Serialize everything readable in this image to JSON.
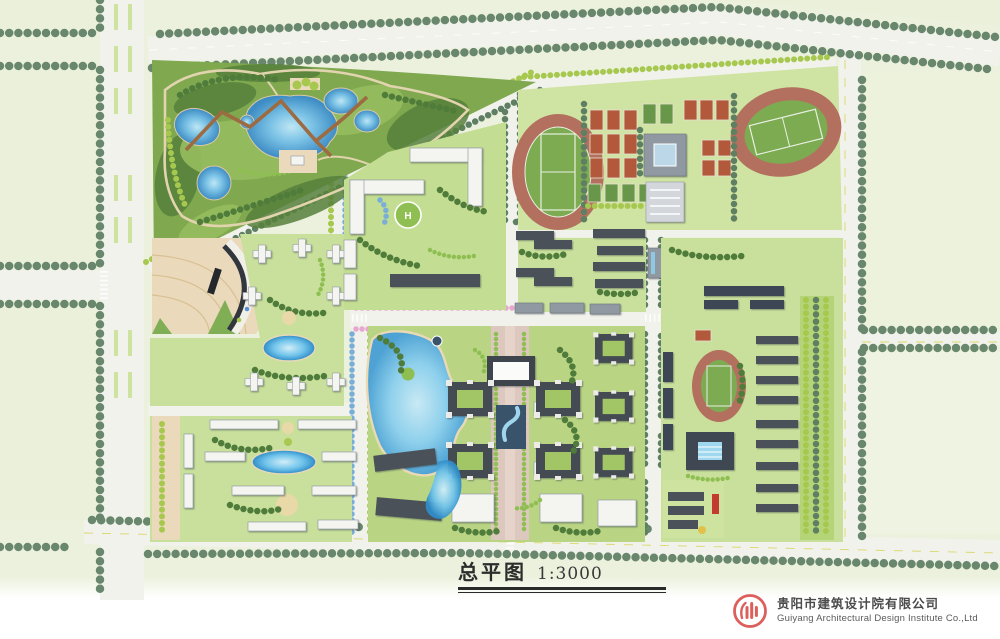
{
  "title": {
    "chinese": "总平图",
    "scale": "1:3000"
  },
  "footer": {
    "company_cn": "贵阳市建筑设计院有限公司",
    "company_en": "Guiyang Architectural Design Institute Co.,Ltd",
    "logo_icon": "design-institute-ring-columns-icon"
  },
  "map": {
    "helipad_label": "H"
  },
  "palette": {
    "paper": "#ffffff",
    "field_green": "#ecf1de",
    "road": "#f1f2ec",
    "street_tree": "#68876c",
    "park_green": "#7fa84f",
    "campus_lawn": "#cfe3a2",
    "water": "#7cc3e6",
    "track_red": "#b4705f",
    "pitch_green": "#7cab52",
    "court_orange": "#b2593b",
    "court_green": "#69974a",
    "roof_dark": "#4b5159",
    "roof_white": "#f4f4f0",
    "paving_beige": "#ead9bb",
    "paving_pink": "#dcc8be",
    "blossom_pink": "#e7a8cd",
    "tree_blue": "#79aed6",
    "logo_red": "#dd5f5c"
  }
}
